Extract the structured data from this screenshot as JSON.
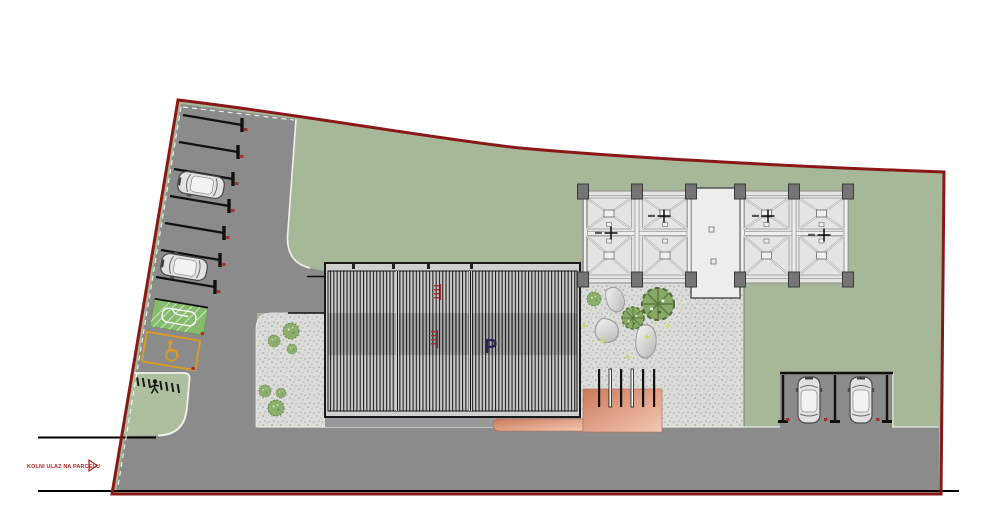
{
  "drawing": {
    "title_hint": "architectural site plan",
    "entrance": {
      "label": "KOLNI ULAZ NA PARCELU"
    },
    "building": {
      "level_label": "P"
    },
    "pergola": {
      "survey_marks": [
        "+",
        "+",
        "+",
        "+"
      ]
    },
    "colors": {
      "parcel_boundary": "#8b1818",
      "grass": "#a7b899",
      "pavement": "#8b8b8b",
      "gravel": "#dcdcd8",
      "louver_dark": "#1f1f1f",
      "ramp_accent": "#cf8263",
      "eco_stall_green": "#86bb6e",
      "accessible_orange": "#d89a28",
      "marking_red": "#b02020",
      "label_navy": "#26265a"
    }
  }
}
